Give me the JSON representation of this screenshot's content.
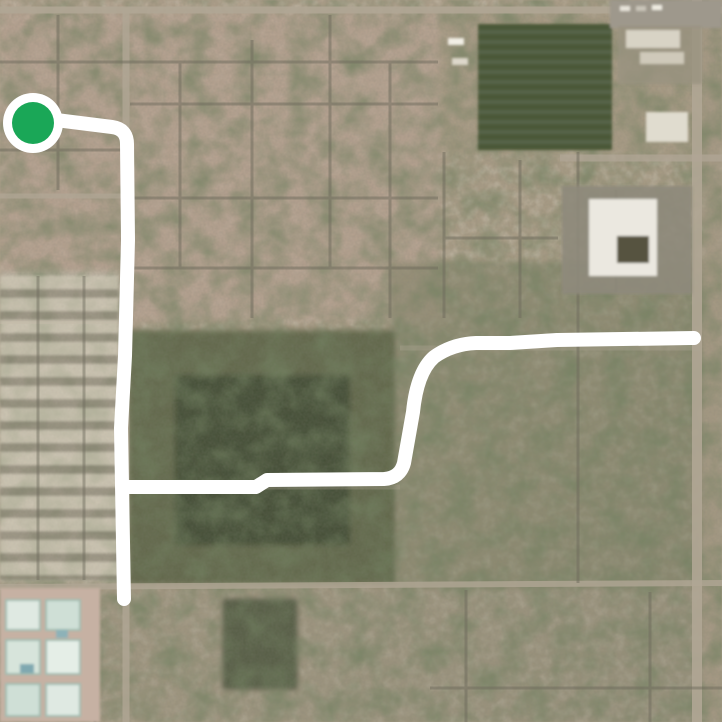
{
  "map": {
    "view_type": "satellite-route-view",
    "route": {
      "color": "#ffffff",
      "width": 14,
      "segments": [
        {
          "name": "start-leg-south",
          "d": "M 48 119 L 112 127 Q 127 129 127 144 L 128 240 L 125 356 L 121 428 L 124 599"
        },
        {
          "name": "east-leg",
          "d": "M 127 487 L 256 487 L 267 480 L 384 479 Q 400 478 404 463 L 413 412 Q 417 372 434 357 Q 452 344 476 343 L 510 343 L 557 340 L 694 338"
        }
      ],
      "start_marker": {
        "cx": 33,
        "cy": 123,
        "outer_r": 30,
        "inner_r": 21,
        "outer_color": "#ffffff",
        "inner_color": "#1aa757"
      }
    },
    "palette": {
      "residential_tan": "#bda795",
      "left_condo_light": "#c9c2b0",
      "estate_olive": "#7e8165",
      "woods_green": "#4d5939",
      "woods_core": "#38452c",
      "field_green": "#4b5839",
      "dirt_tan": "#a89a84",
      "road_light": "#b0a695",
      "street_dark": "#6d6a5c",
      "building_white": "#ebe8e0",
      "building_court": "#56533f",
      "parking_gray": "#8e897b",
      "resort_ground": "#c6b1a3",
      "resort_roof": "#dfe9e2",
      "bottom_olive": "#9a937c",
      "dark_parcel": "#47523a"
    }
  }
}
